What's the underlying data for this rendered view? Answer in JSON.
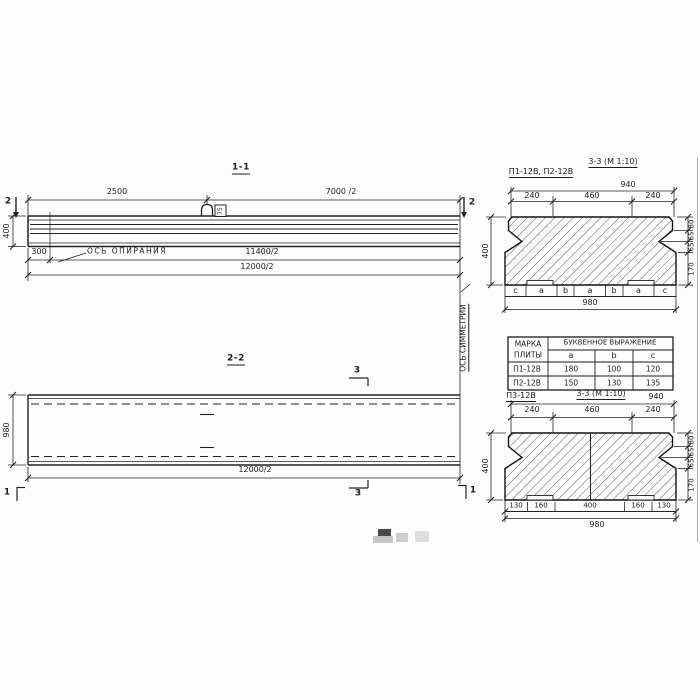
{
  "section_1_1": {
    "title": "1-1",
    "dim_top_left": "2500",
    "dim_top_right": "7000 /2",
    "cut_marker_2": "2",
    "height_dim": "400",
    "support_offset_dim": "300",
    "support_axis_label": "ОСЬ ОПИРАНИЯ",
    "dim_11400": "11400/2",
    "dim_12000": "12000/2",
    "loop_label": "75"
  },
  "section_2_2": {
    "title": "2-2",
    "cut_marker_3": "3",
    "cut_marker_1": "1",
    "width_dim": "980",
    "dim_12000": "12000/2",
    "symmetry_axis_label": "ОСЬ СИММЕТРИИ"
  },
  "cross_section_p12": {
    "plate_marks": "П1-12В, П2-12В",
    "title": "3-3 (М 1:10)",
    "dim_total_top": "940",
    "top_segments": [
      "240",
      "460",
      "240"
    ],
    "height_total": "400",
    "height_segments": [
      "80",
      "65",
      "65",
      "170"
    ],
    "letter_segments": [
      "c",
      "a",
      "b",
      "a",
      "b",
      "a",
      "c"
    ],
    "dim_total_bottom": "980"
  },
  "letter_table": {
    "col_header_line1": "МАРКА",
    "col_header_line2": "ПЛИТЫ",
    "group_header": "БУКВЕННОЕ ВЫРАЖЕНИЕ",
    "columns": [
      "a",
      "b",
      "c"
    ],
    "rows": [
      {
        "mark": "П1-12В",
        "a": "180",
        "b": "100",
        "c": "120"
      },
      {
        "mark": "П2-12В",
        "a": "150",
        "b": "130",
        "c": "135"
      }
    ]
  },
  "cross_section_p3": {
    "plate_mark": "П3-12В",
    "title": "3-3 (М 1:10)",
    "dim_total_top": "940",
    "top_segments": [
      "240",
      "460",
      "240"
    ],
    "height_total": "400",
    "height_segments": [
      "80",
      "65",
      "65",
      "170"
    ],
    "bottom_segments": [
      "130",
      "160",
      "400",
      "160",
      "130"
    ],
    "dim_total_bottom": "980"
  }
}
